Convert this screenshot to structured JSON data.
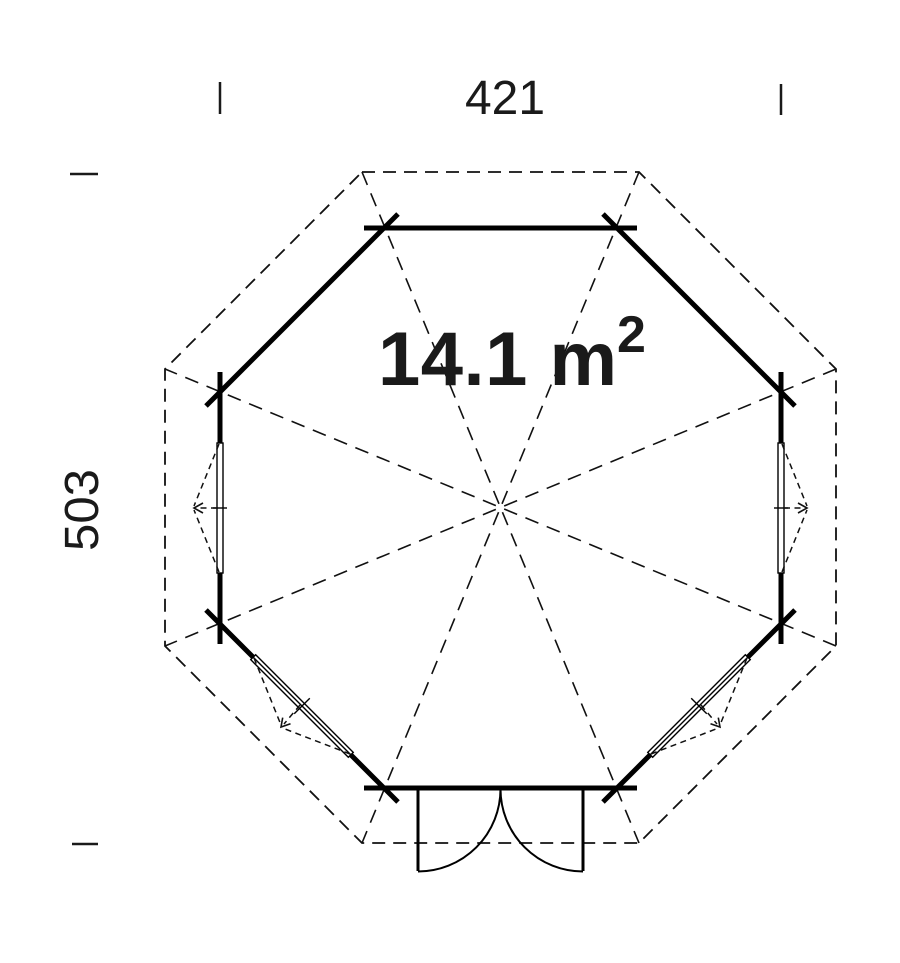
{
  "drawing": {
    "dimensions": {
      "width_label": "421",
      "height_label": "503"
    },
    "area": {
      "value": "14.1 m",
      "superscript": "2",
      "full": "14.1 m²"
    },
    "colors": {
      "line": "#000000",
      "text": "#1a1a1a",
      "background": "#ffffff"
    }
  }
}
